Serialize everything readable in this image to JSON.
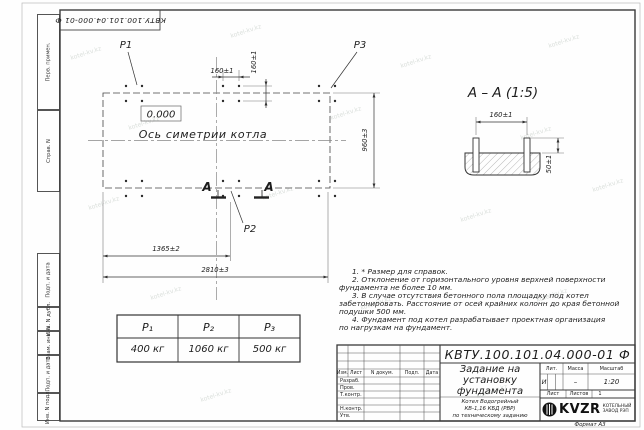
{
  "doc_number": "КВТУ.100.101.04.000-01 Ф",
  "watermark": "kotel-kv.kz",
  "frame_strip": {
    "items": [
      "Перв. примен.",
      "Справ. N",
      "Подп. и дата",
      "Инв. N дубл.",
      "Взам. инв. N",
      "Подп. и дата",
      "Инв. N подл."
    ]
  },
  "plan": {
    "label_p1": "P1",
    "label_p2": "P2",
    "label_p3": "P3",
    "elevation": "0.000",
    "axis_label": "Ось симетрии котла",
    "section_mark": "А",
    "dim_bolt_h": "160±1",
    "dim_bolt_v": "160±1",
    "dim_width": "960±3",
    "dim_center": "1365±2",
    "dim_length": "2810±3"
  },
  "section_view": {
    "title": "А – А (1:5)",
    "dim_spacing": "160±1",
    "dim_height": "50±1"
  },
  "notes": {
    "n1": [
      "1. * Размер для справок."
    ],
    "n2": [
      "2. Отклонение от горизонтального уровня верхней поверхности",
      "фундамента не более 10 мм."
    ],
    "n3": [
      "3. В случае отсутствия бетонного пола площадку под котел",
      "забетонировать. Расстояние от осей крайних колонн до края бетонной",
      "подушки 500 мм."
    ],
    "n4": [
      "4. Фундамент под котел разрабатывает проектная организация",
      "по нагрузкам на фундамент."
    ]
  },
  "load_table": {
    "headers": [
      "P₁",
      "P₂",
      "P₃"
    ],
    "values": [
      "400 кг",
      "1060 кг",
      "500 кг"
    ]
  },
  "title_block": {
    "change_cols": {
      "izm": "Изм.",
      "list": "Лист",
      "doc": "N докум.",
      "sign": "Подп.",
      "date": "Дата"
    },
    "sign_rows": {
      "r1": "Разраб.",
      "r2": "Пров.",
      "r3": "Т.контр.",
      "r4": "Н.контр.",
      "r5": "Утв."
    },
    "title_lines": [
      "Задание на",
      "установку",
      "фундамента"
    ],
    "product_lines": [
      "Котел Водогрейный",
      "КВ-1,16 КБД (РВР)",
      "по техническому заданию"
    ],
    "lit_label": "Лит.",
    "mass_label": "Масса",
    "scale_label": "Масштаб",
    "lit_value": "И",
    "mass_value": "–",
    "scale_value": "1:20",
    "sheet_label": "Лист",
    "sheets_label": "Листов",
    "sheets_value": "1",
    "logo": {
      "name": "KVZR",
      "line1": "КОТЕЛЬНЫЙ",
      "line2": "ЗАВОД РЭП"
    },
    "format_label": "Формат А3"
  }
}
